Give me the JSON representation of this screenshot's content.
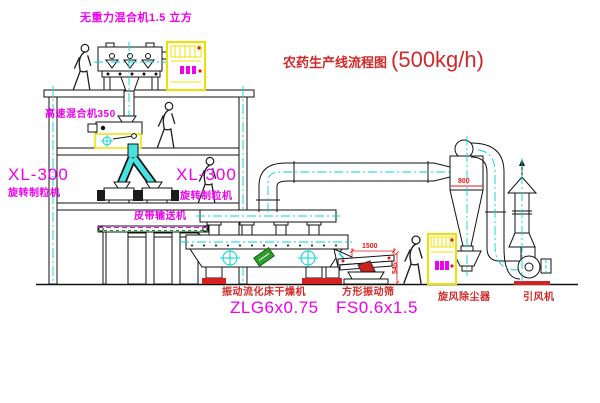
{
  "title": {
    "text": "农药生产线流程图",
    "capacity": "(500kg/h)"
  },
  "labels": {
    "top_mixer": "无重力混合机1.5 立方",
    "high_speed_mixer": "高速混合机350",
    "granulator_left_model": "XL-300",
    "granulator_left_name": "旋转制粒机",
    "granulator_right_model": "XL-300",
    "granulator_right_name": "旋转制粒机",
    "belt_conveyor": "皮带输送机",
    "dryer_name": "振动流化床干燥机",
    "dryer_model": "ZLG6x0.75",
    "screen_name": "方形振动筛",
    "screen_model": "FS0.6x1.5",
    "cyclone_name": "旋风除尘器",
    "fan_name": "引风机"
  },
  "dimensions": {
    "screen_length": "1500",
    "screen_height": "545",
    "cyclone_inlet": "800"
  },
  "colors": {
    "label_magenta": "#ee00ee",
    "label_red": "#cf2a2a",
    "centerline_cyan": "#00d5d5",
    "cabinet_yellow": "#f0e000",
    "tag_green": "#2f9e2f",
    "accent_red": "#d42222"
  }
}
